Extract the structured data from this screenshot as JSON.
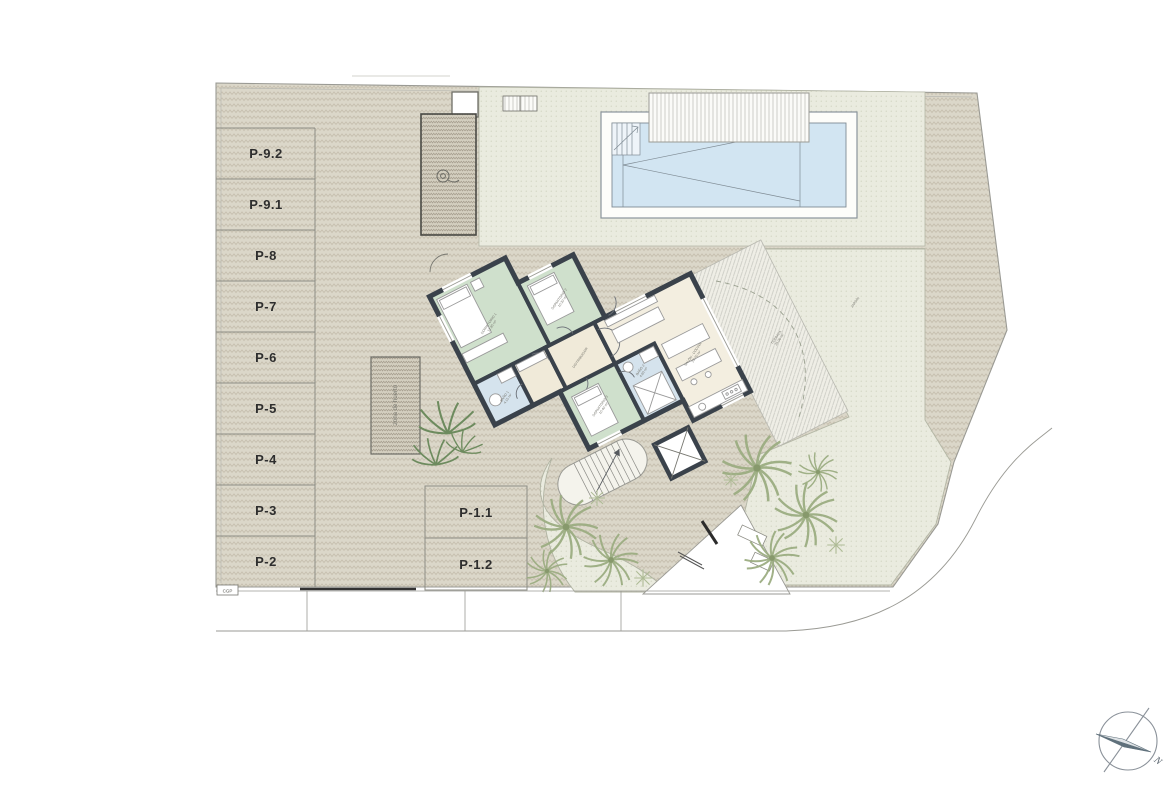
{
  "plan": {
    "parking_row": [
      "P-9.2",
      "P-9.1",
      "P-8",
      "P-7",
      "P-6",
      "P-5",
      "P-4",
      "P-3",
      "P-2"
    ],
    "parking_front": [
      "P-1.1",
      "P-1.2"
    ],
    "rooms": {
      "bedroom1": {
        "name": "DORMITORIO 1",
        "area": "12.85 m²"
      },
      "bedroom2": {
        "name": "DORMITORIO 2",
        "area": "10.20 m²"
      },
      "bedroom3": {
        "name": "DORMITORIO 3",
        "area": "10.40 m²"
      },
      "bath1": {
        "name": "BAÑO 1",
        "area": "4.15 m²"
      },
      "bath2": {
        "name": "BAÑO 2",
        "area": "4.60 m²"
      },
      "hall": {
        "name": "DISTRIBUIDOR",
        "area": ""
      },
      "living": {
        "name": "SALÓN - COCINA",
        "area": "29.70 m²"
      }
    },
    "outdoor": {
      "terrace_name": "TERRAZA",
      "terrace_area": "24.00 m²",
      "garden_name": "JARDÍN",
      "planter_label": "zona de huerto",
      "cgp": "CGP"
    },
    "compass": {
      "north": "N"
    },
    "colors": {
      "bedroom": "#cfe0cc",
      "bath": "#d5e3ed",
      "living": "#f3eee0",
      "wall": "#3a424b",
      "pool_water": "#d2e5f2",
      "paving": "#dbd7c9",
      "garden": "#eaebdf"
    }
  }
}
